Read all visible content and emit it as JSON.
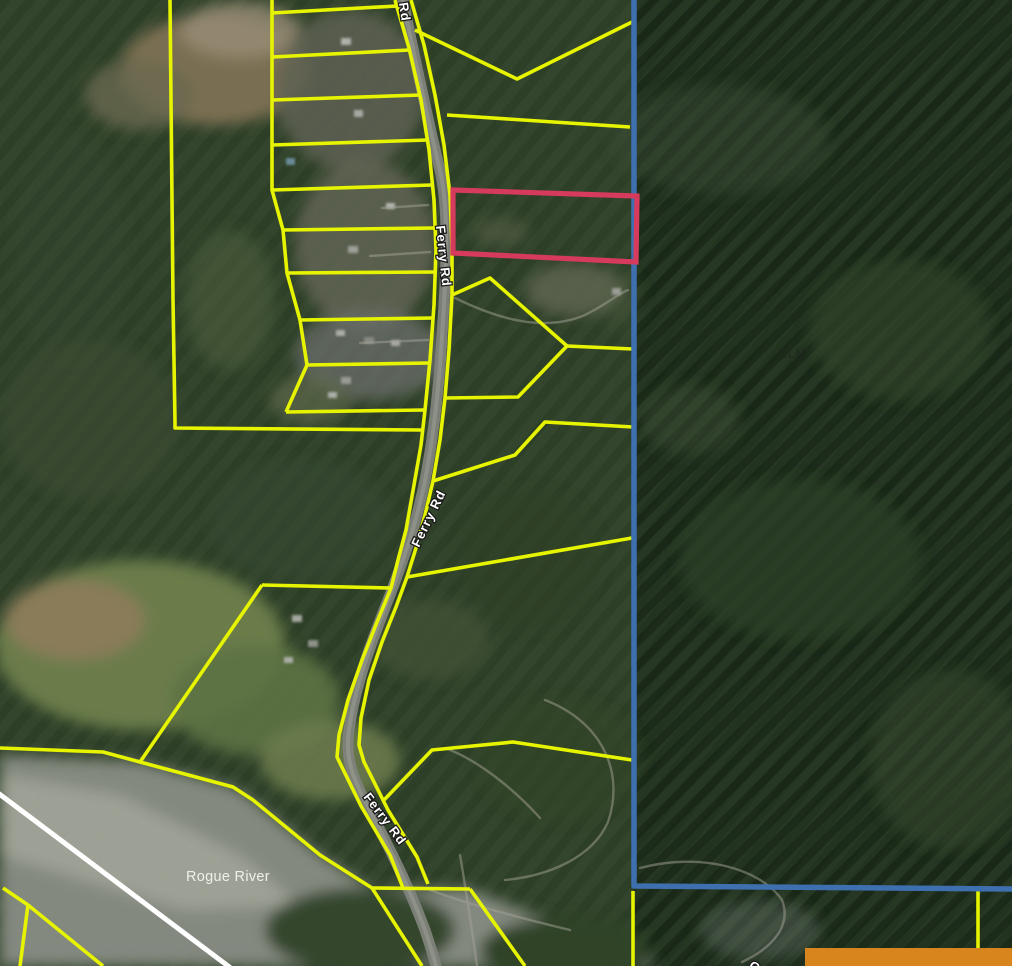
{
  "map": {
    "road_labels": {
      "top_partial": "Rd",
      "upper": "Ferry Rd",
      "middle": "Ferry Rd",
      "lower": "Ferry Rd",
      "bottom_partial": "G"
    },
    "area_labels": {
      "federal_land": "BLM",
      "river": "Rogue River"
    },
    "colors": {
      "parcel_line": "#e7f400",
      "boundary_line": "#3e6fae",
      "highlight_parcel": "#d63a5c",
      "overlay_box": "#d9851e",
      "section_line": "#ffffff"
    }
  }
}
